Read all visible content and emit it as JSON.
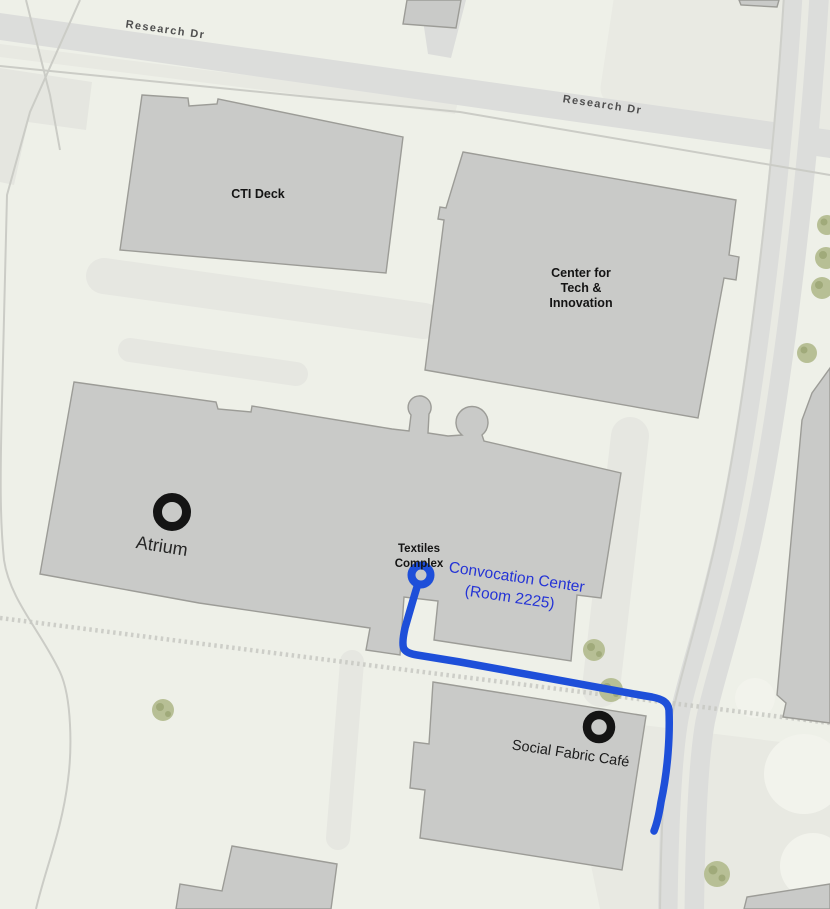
{
  "map": {
    "kind": "campus-walking-route-map",
    "streets": {
      "research_dr_1": "Research Dr",
      "research_dr_2": "Research Dr"
    },
    "buildings": {
      "cti_deck": "CTI Deck",
      "center_tech_line1": "Center for",
      "center_tech_line2": "Tech &",
      "center_tech_line3": "Innovation",
      "textiles_line1": "Textiles",
      "textiles_line2": "Complex"
    },
    "pois": {
      "atrium": "Atrium",
      "social_fabric_cafe": "Social Fabric Café"
    },
    "route": {
      "destination_line1": "Convocation Center",
      "destination_line2": "(Room 2225)"
    },
    "colors": {
      "route_blue": "#1e4fd9",
      "destination_text_blue": "#2433d6",
      "marker_black": "#141414",
      "building_fill": "#c9cac8",
      "building_stroke": "#9c9c97",
      "road_fill": "#dcdddb",
      "background": "#eef0e8",
      "tree_green": "#b7bf95"
    }
  }
}
